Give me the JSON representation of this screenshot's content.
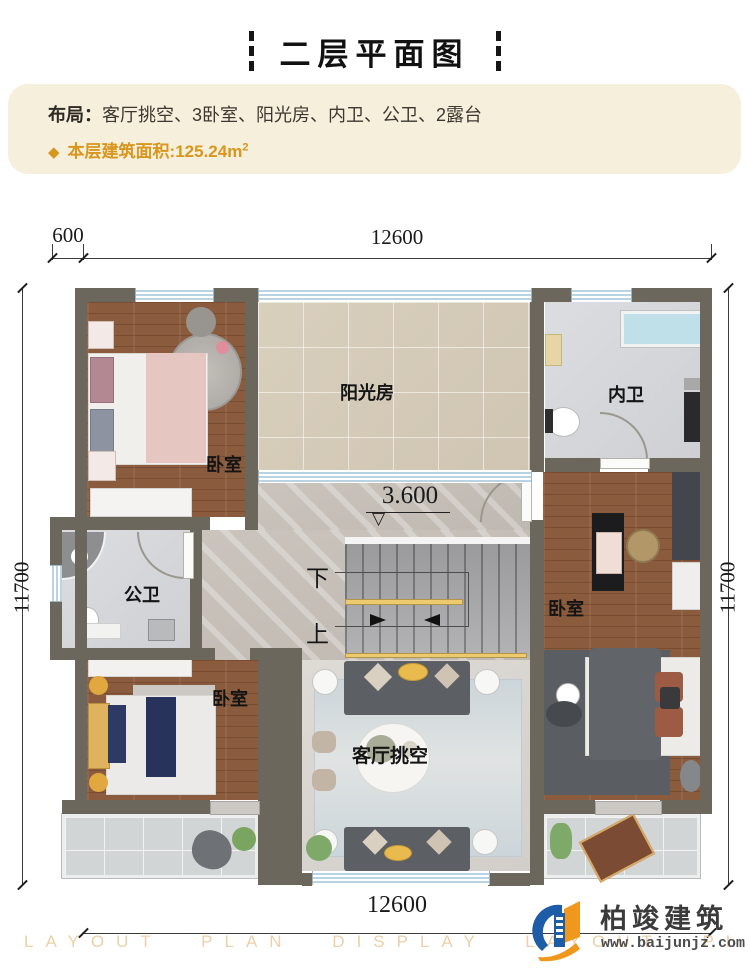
{
  "palette": {
    "accent_orange": "#d8961c",
    "info_bg": "#f6efdc",
    "wall": "#6c675c",
    "wood_floor": "#8a5b3d",
    "sunroom_floor": "#d5cbb8",
    "bath_floor": "#d8d9dc",
    "hall_floor": "#c6c0b9",
    "terrace_floor": "#d2d5d6",
    "window_blue": "#b9d3e2",
    "rail_yellow": "#ecca6e",
    "logo_blue": "#1d5ca6",
    "logo_orange": "#f0981e"
  },
  "header": {
    "title": "二层平面图"
  },
  "info": {
    "layout_label": "布局：",
    "layout_value": "客厅挑空、3卧室、阳光房、内卫、公卫、2露台",
    "diamond": "◆",
    "area_label": "本层建筑面积:",
    "area_value": "125.24m",
    "area_sup": "2"
  },
  "plan": {
    "rooms": [
      {
        "id": "bedroom-top-left",
        "label": "卧室"
      },
      {
        "id": "sunroom",
        "label": "阳光房"
      },
      {
        "id": "bath-inner",
        "label": "内卫"
      },
      {
        "id": "bath-public",
        "label": "公卫"
      },
      {
        "id": "bedroom-right",
        "label": "卧室"
      },
      {
        "id": "bedroom-bottom-left",
        "label": "卧室"
      },
      {
        "id": "living-void",
        "label": "客厅挑空"
      }
    ],
    "stairs": {
      "down": "下",
      "up": "上"
    },
    "elevation": {
      "value": "3.600",
      "symbol": "▽"
    },
    "dimensions": {
      "top_left": "600",
      "top": "12600",
      "left": "11700",
      "right": "11700",
      "bottom": "12600"
    }
  },
  "footer": {
    "watermark": "LAYOUT PLAN DISPLAY LAYOUT PLAN DISPLAY",
    "logo_name": "柏竣建筑",
    "logo_url": "www.baijunjz.com"
  }
}
